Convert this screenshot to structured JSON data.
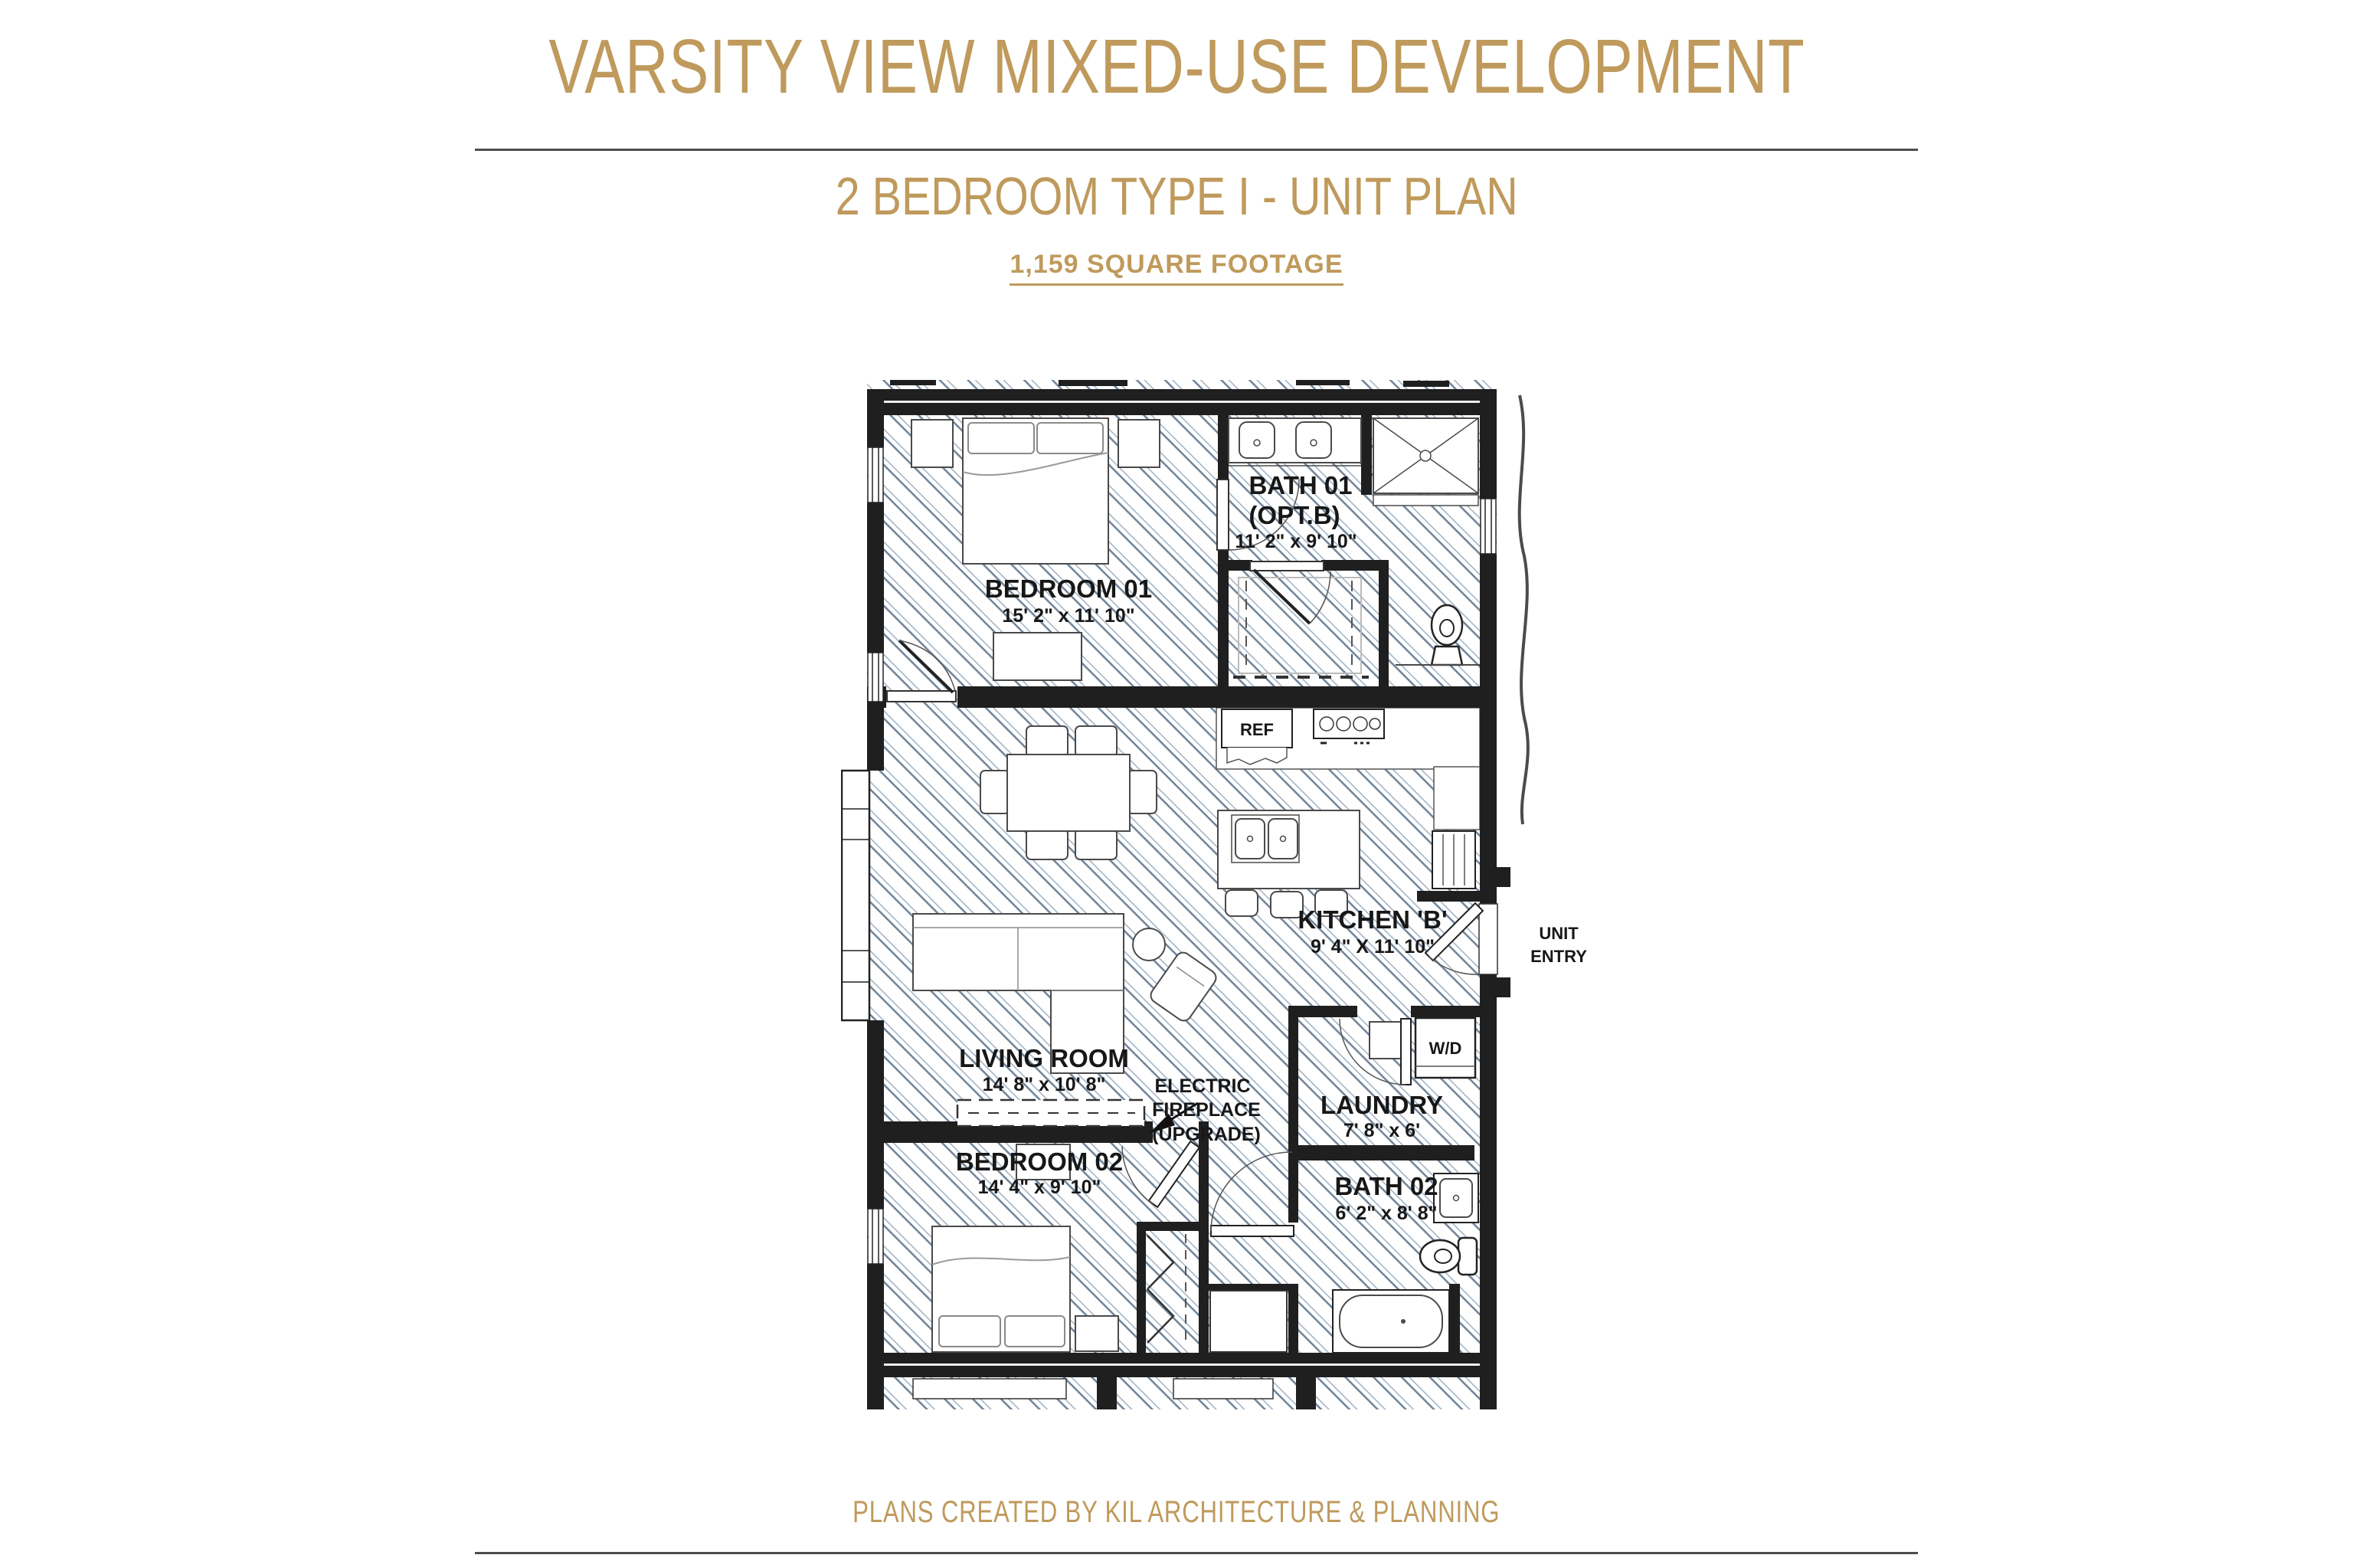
{
  "header": {
    "title": "VARSITY VIEW MIXED-USE DEVELOPMENT",
    "subtitle": "2 BEDROOM TYPE I - UNIT PLAN",
    "square_footage": "1,159 SQUARE FOOTAGE"
  },
  "footer": {
    "credit": "PLANS CREATED BY KIL ARCHITECTURE & PLANNING"
  },
  "colors": {
    "accent_gold": "#bf9a5c",
    "wall_black": "#1f1f1f",
    "hatch_light": "#9db0c4",
    "hatch_dark": "#6e8298",
    "divider_gray": "#4d4d4d"
  },
  "plan": {
    "rooms": [
      {
        "id": "bedroom01",
        "label": "BEDROOM 01",
        "dims": "15' 2\" x 11' 10\""
      },
      {
        "id": "bath01",
        "label": "BATH 01",
        "label2": "(OPT.B)",
        "dims": "11' 2\" x 9' 10\""
      },
      {
        "id": "kitchen",
        "label": "KITCHEN 'B'",
        "dims": "9' 4\" X 11' 10\""
      },
      {
        "id": "living",
        "label": "LIVING ROOM",
        "dims": "14' 8\" x 10' 8\""
      },
      {
        "id": "bedroom02",
        "label": "BEDROOM 02",
        "dims": "14' 4\" x 9' 10\""
      },
      {
        "id": "laundry",
        "label": "LAUNDRY",
        "dims": "7' 8\" x 6'"
      },
      {
        "id": "bath02",
        "label": "BATH 02",
        "dims": "6' 2\" x 8' 8\""
      }
    ],
    "annotations": {
      "electric_fireplace": [
        "ELECTRIC",
        "FIREPLACE",
        "(UPGRADE)"
      ],
      "ref": "REF",
      "wd": "W/D",
      "unit_entry": [
        "UNIT",
        "ENTRY"
      ]
    }
  }
}
